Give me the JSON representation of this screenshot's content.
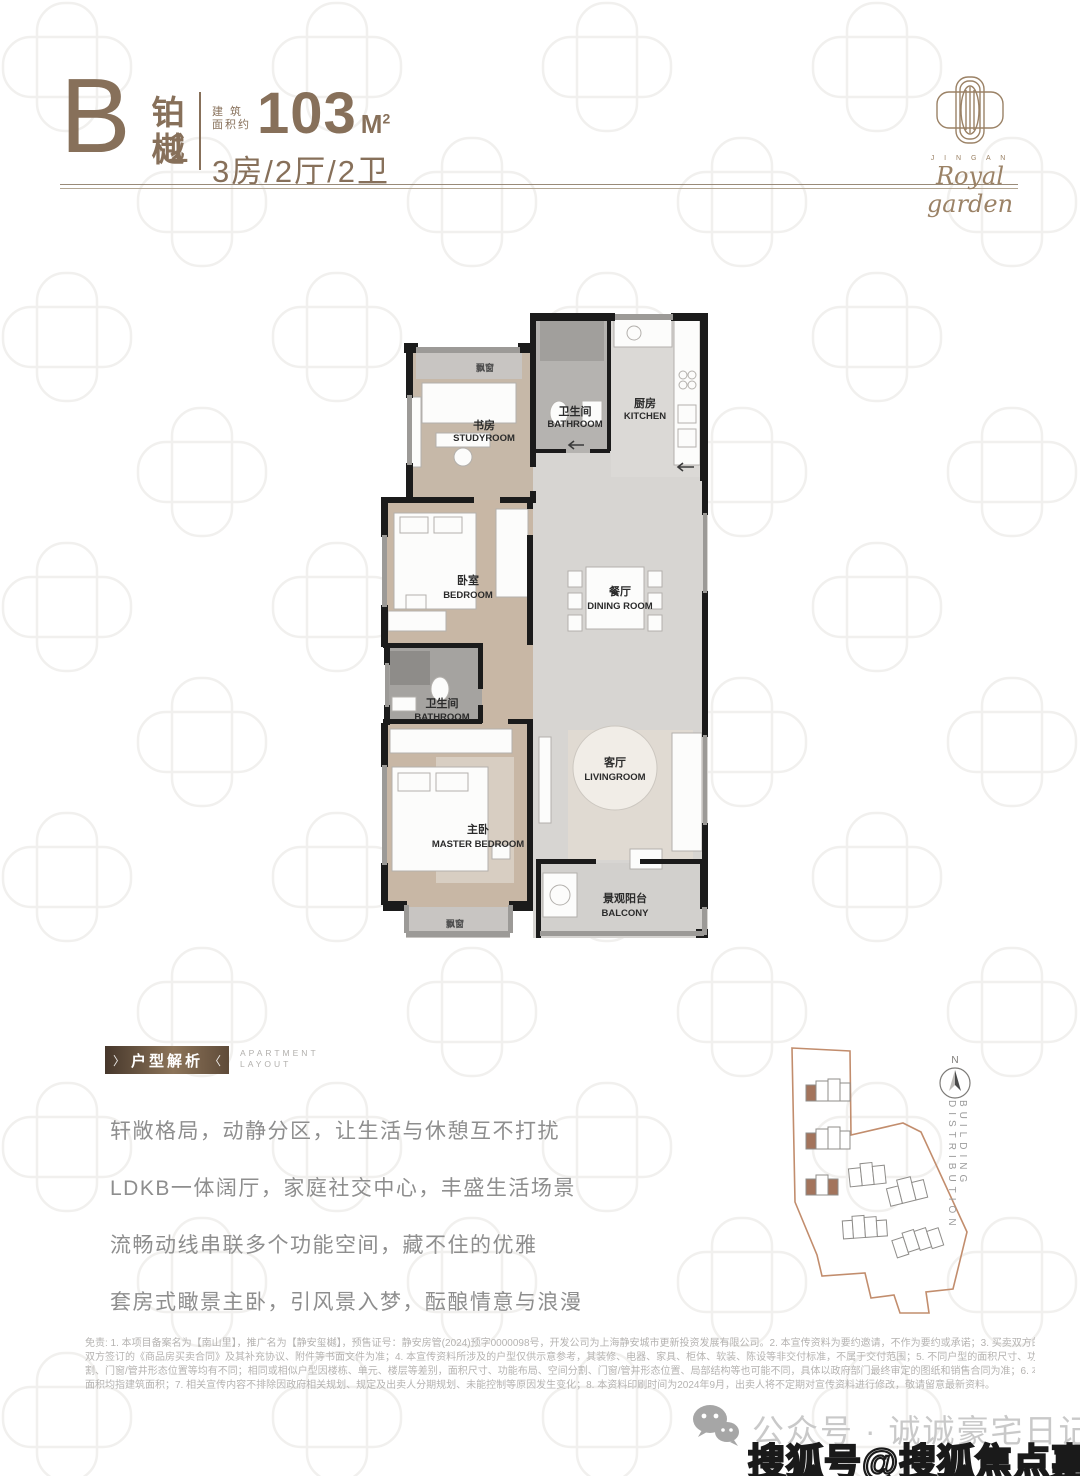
{
  "colors": {
    "accent_brown": "#87705a",
    "banner_gradient_dark": "#46372b",
    "banner_gradient_light": "#8c7459",
    "site_boundary": "#c28d6d",
    "wall_black": "#1b1b1b",
    "highlight_building": "#a3745c"
  },
  "header": {
    "type_letter": "B",
    "type_number": "1",
    "type_name_char1": "铂",
    "type_name_char2": "樾",
    "area_label_line1": "建 筑",
    "area_label_line2": "面积约",
    "area_value": "103",
    "area_unit": "M",
    "area_unit_sup": "2",
    "layout_spec": "3房/2厅/2卫"
  },
  "logo": {
    "subtext": "J I N G A N",
    "script": "Royal garden"
  },
  "floorplan": {
    "bay_window_top": "飘窗",
    "bay_window_bottom": "飘窗",
    "rooms": [
      {
        "cn": "书房",
        "en": "STUDYROOM"
      },
      {
        "cn": "卫生间",
        "en": "BATHROOM"
      },
      {
        "cn": "厨房",
        "en": "KITCHEN"
      },
      {
        "cn": "卧室",
        "en": "BEDROOM"
      },
      {
        "cn": "餐厅",
        "en": "DINING ROOM"
      },
      {
        "cn": "卫生间",
        "en": "BATHROOM"
      },
      {
        "cn": "主卧",
        "en": "MASTER BEDROOM"
      },
      {
        "cn": "客厅",
        "en": "LIVINGROOM"
      },
      {
        "cn": "景观阳台",
        "en": "BALCONY"
      }
    ]
  },
  "analysis": {
    "badge_text": "户型解析",
    "badge_chevron_left": "〉",
    "badge_chevron_right": "〈",
    "subtitle_line1": "APARTMENT",
    "subtitle_line2": "LAYOUT",
    "paragraphs": [
      "轩敞格局，动静分区，让生活与休憩互不打扰",
      "LDKB一体阔厅，家庭社交中心，丰盛生活场景",
      "流畅动线串联多个功能空间，藏不住的优雅",
      "套房式瞰景主卧，引风景入梦，酝酿情意与浪漫"
    ]
  },
  "siteplan": {
    "north_label": "N",
    "caption": "BUILDING DISTRIBUTION"
  },
  "disclaimer": {
    "lines": [
      "免责: 1. 本项目备案名为【南山里】，推广名为【静安玺樾】，预售证号：静安房管(2024)预字0000098号，开发公司为上海静安城市更新投资发展有限公司。2. 本宣传资料为要约邀请，不作为要约或承诺；3. 买卖双方的权利义务以",
      "双方签订的《商品房买卖合同》及其补充协议、附件等书面文件为准；4. 本宣传资料所涉及的户型仅供示意参考，其装修、电器、家具、柜体、软装、陈设等非交付标准，不属于交付范围；5. 不同户型的面积尺寸、功能布局、空间分",
      "割、门窗/管井形态位置等均有不同；相同或相似户型因楼栋、单元、楼层等差别，面积尺寸、功能布局、空间分割、门窗/管井形态位置、局部结构等也可能不同，具体以政府部门最终审定的图纸和销售合同为准；6. 本资料中所述",
      "面积均指建筑面积；7. 相关宣传内容不排除因政府相关规划、规定及出卖人分期规划、未能控制等原因发生变化；8. 本资料印刷时间为2024年9月，出卖人将不定期对宣传资料进行修改，敬请留意最新资料。"
    ]
  },
  "watermarks": {
    "wechat_label": "公众号 · 诚诚豪宅日记",
    "sohu_label": "搜狐号@搜狐焦点嘉哈关站"
  }
}
